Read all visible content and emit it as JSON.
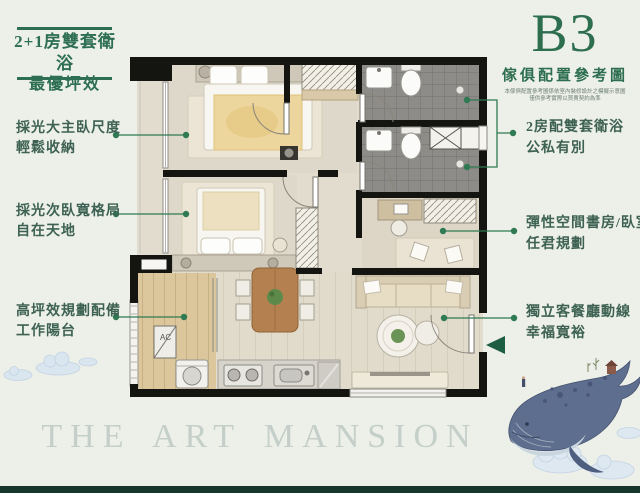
{
  "page": {
    "type": "real-estate floor plan flyer",
    "colors": {
      "background": "#edefe9",
      "accent_green": "#2d6f50",
      "footer_bar": "#17362b",
      "watermark": "#c5cfc9",
      "entry_marker": "#1d5e40"
    }
  },
  "header": {
    "tagline_line1": "2+1房雙套衛浴",
    "tagline_line2": "最優坪效"
  },
  "unit": {
    "code": "B3",
    "subtitle": "傢俱配置參考圖",
    "disclaimer_line1": "本傢俱配置參考圖係依室內裝修設計之模擬示意圖",
    "disclaimer_line2": "僅供參考實際以買賣契約為準"
  },
  "annotations": {
    "left": [
      {
        "line1": "採光大主臥尺度",
        "line2": "輕鬆收納"
      },
      {
        "line1": "採光次臥寬格局",
        "line2": "自在天地"
      },
      {
        "line1": "高坪效規劃配備",
        "line2": "工作陽台"
      }
    ],
    "right": [
      {
        "line1": "2房配雙套衛浴",
        "line2": "公私有別"
      },
      {
        "line1": "彈性空間書房/臥室",
        "line2": "任君規劃"
      },
      {
        "line1": "獨立客餐廳動線",
        "line2": "幸福寬裕"
      }
    ]
  },
  "floorplan": {
    "ac_label": "AC"
  },
  "watermark": {
    "text": "THE ART MANSION"
  }
}
